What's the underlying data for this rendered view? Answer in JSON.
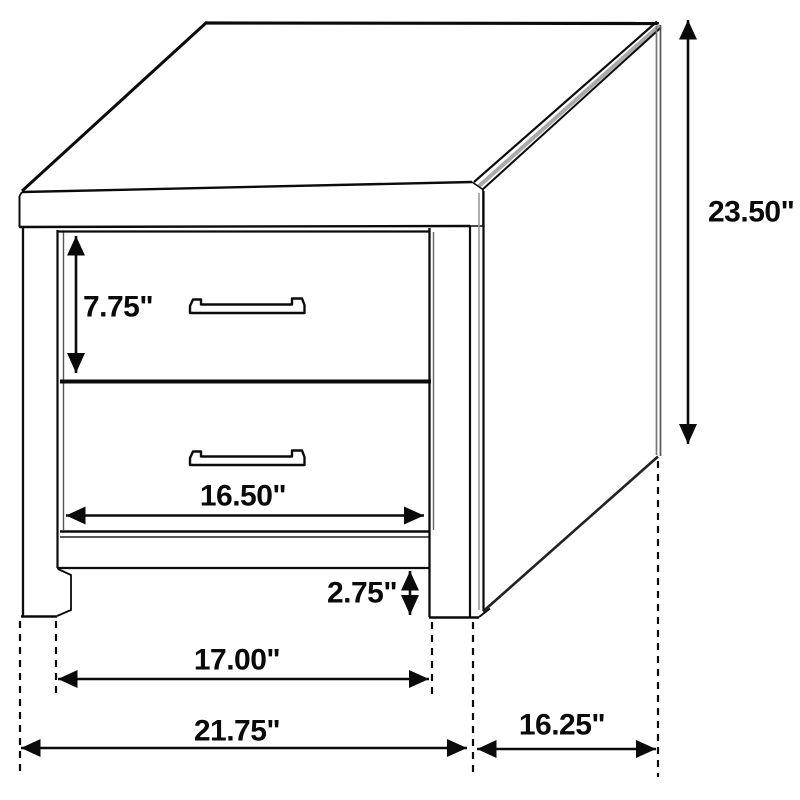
{
  "diagram": {
    "subject": "two-drawer nightstand dimension drawing",
    "units": "inches",
    "background_color": "#ffffff",
    "line_color": "#0b0b0b"
  },
  "dims": {
    "overall_height": "23.50\"",
    "top_drawer_height": "7.75\"",
    "drawer_front_width": "16.50\"",
    "base_clearance": "2.75\"",
    "between_legs_width": "17.00\"",
    "overall_width": "21.75\"",
    "side_depth": "16.25\""
  }
}
